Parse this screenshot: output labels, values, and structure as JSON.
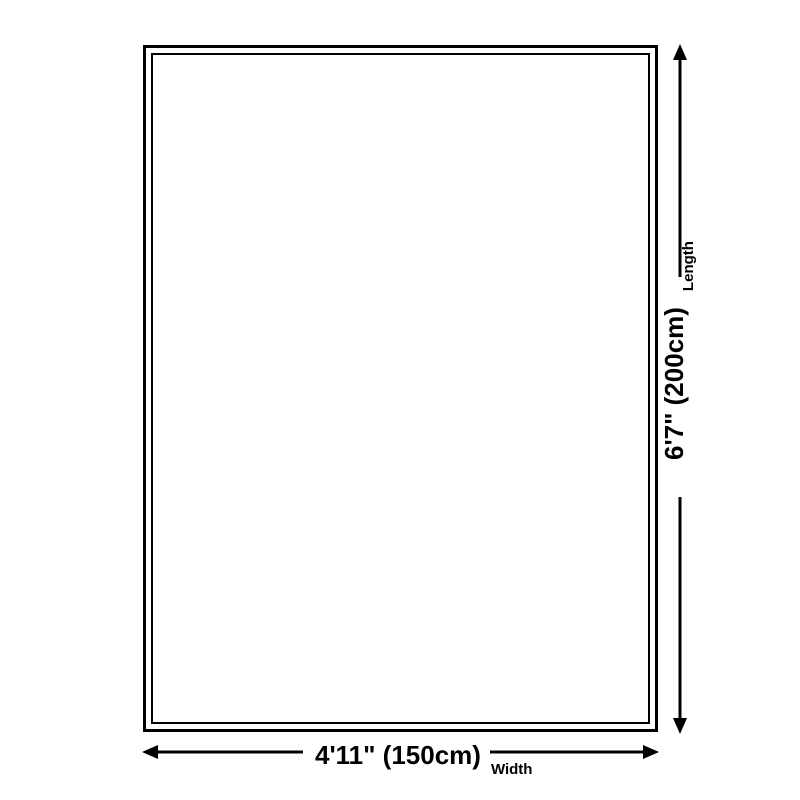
{
  "dimensions": {
    "width": {
      "value": "4'11\" (150cm)",
      "label": "Width"
    },
    "length": {
      "value": "6'7\" (200cm)",
      "label": "Length"
    }
  },
  "colors": {
    "line": "#000000",
    "background": "#ffffff"
  }
}
